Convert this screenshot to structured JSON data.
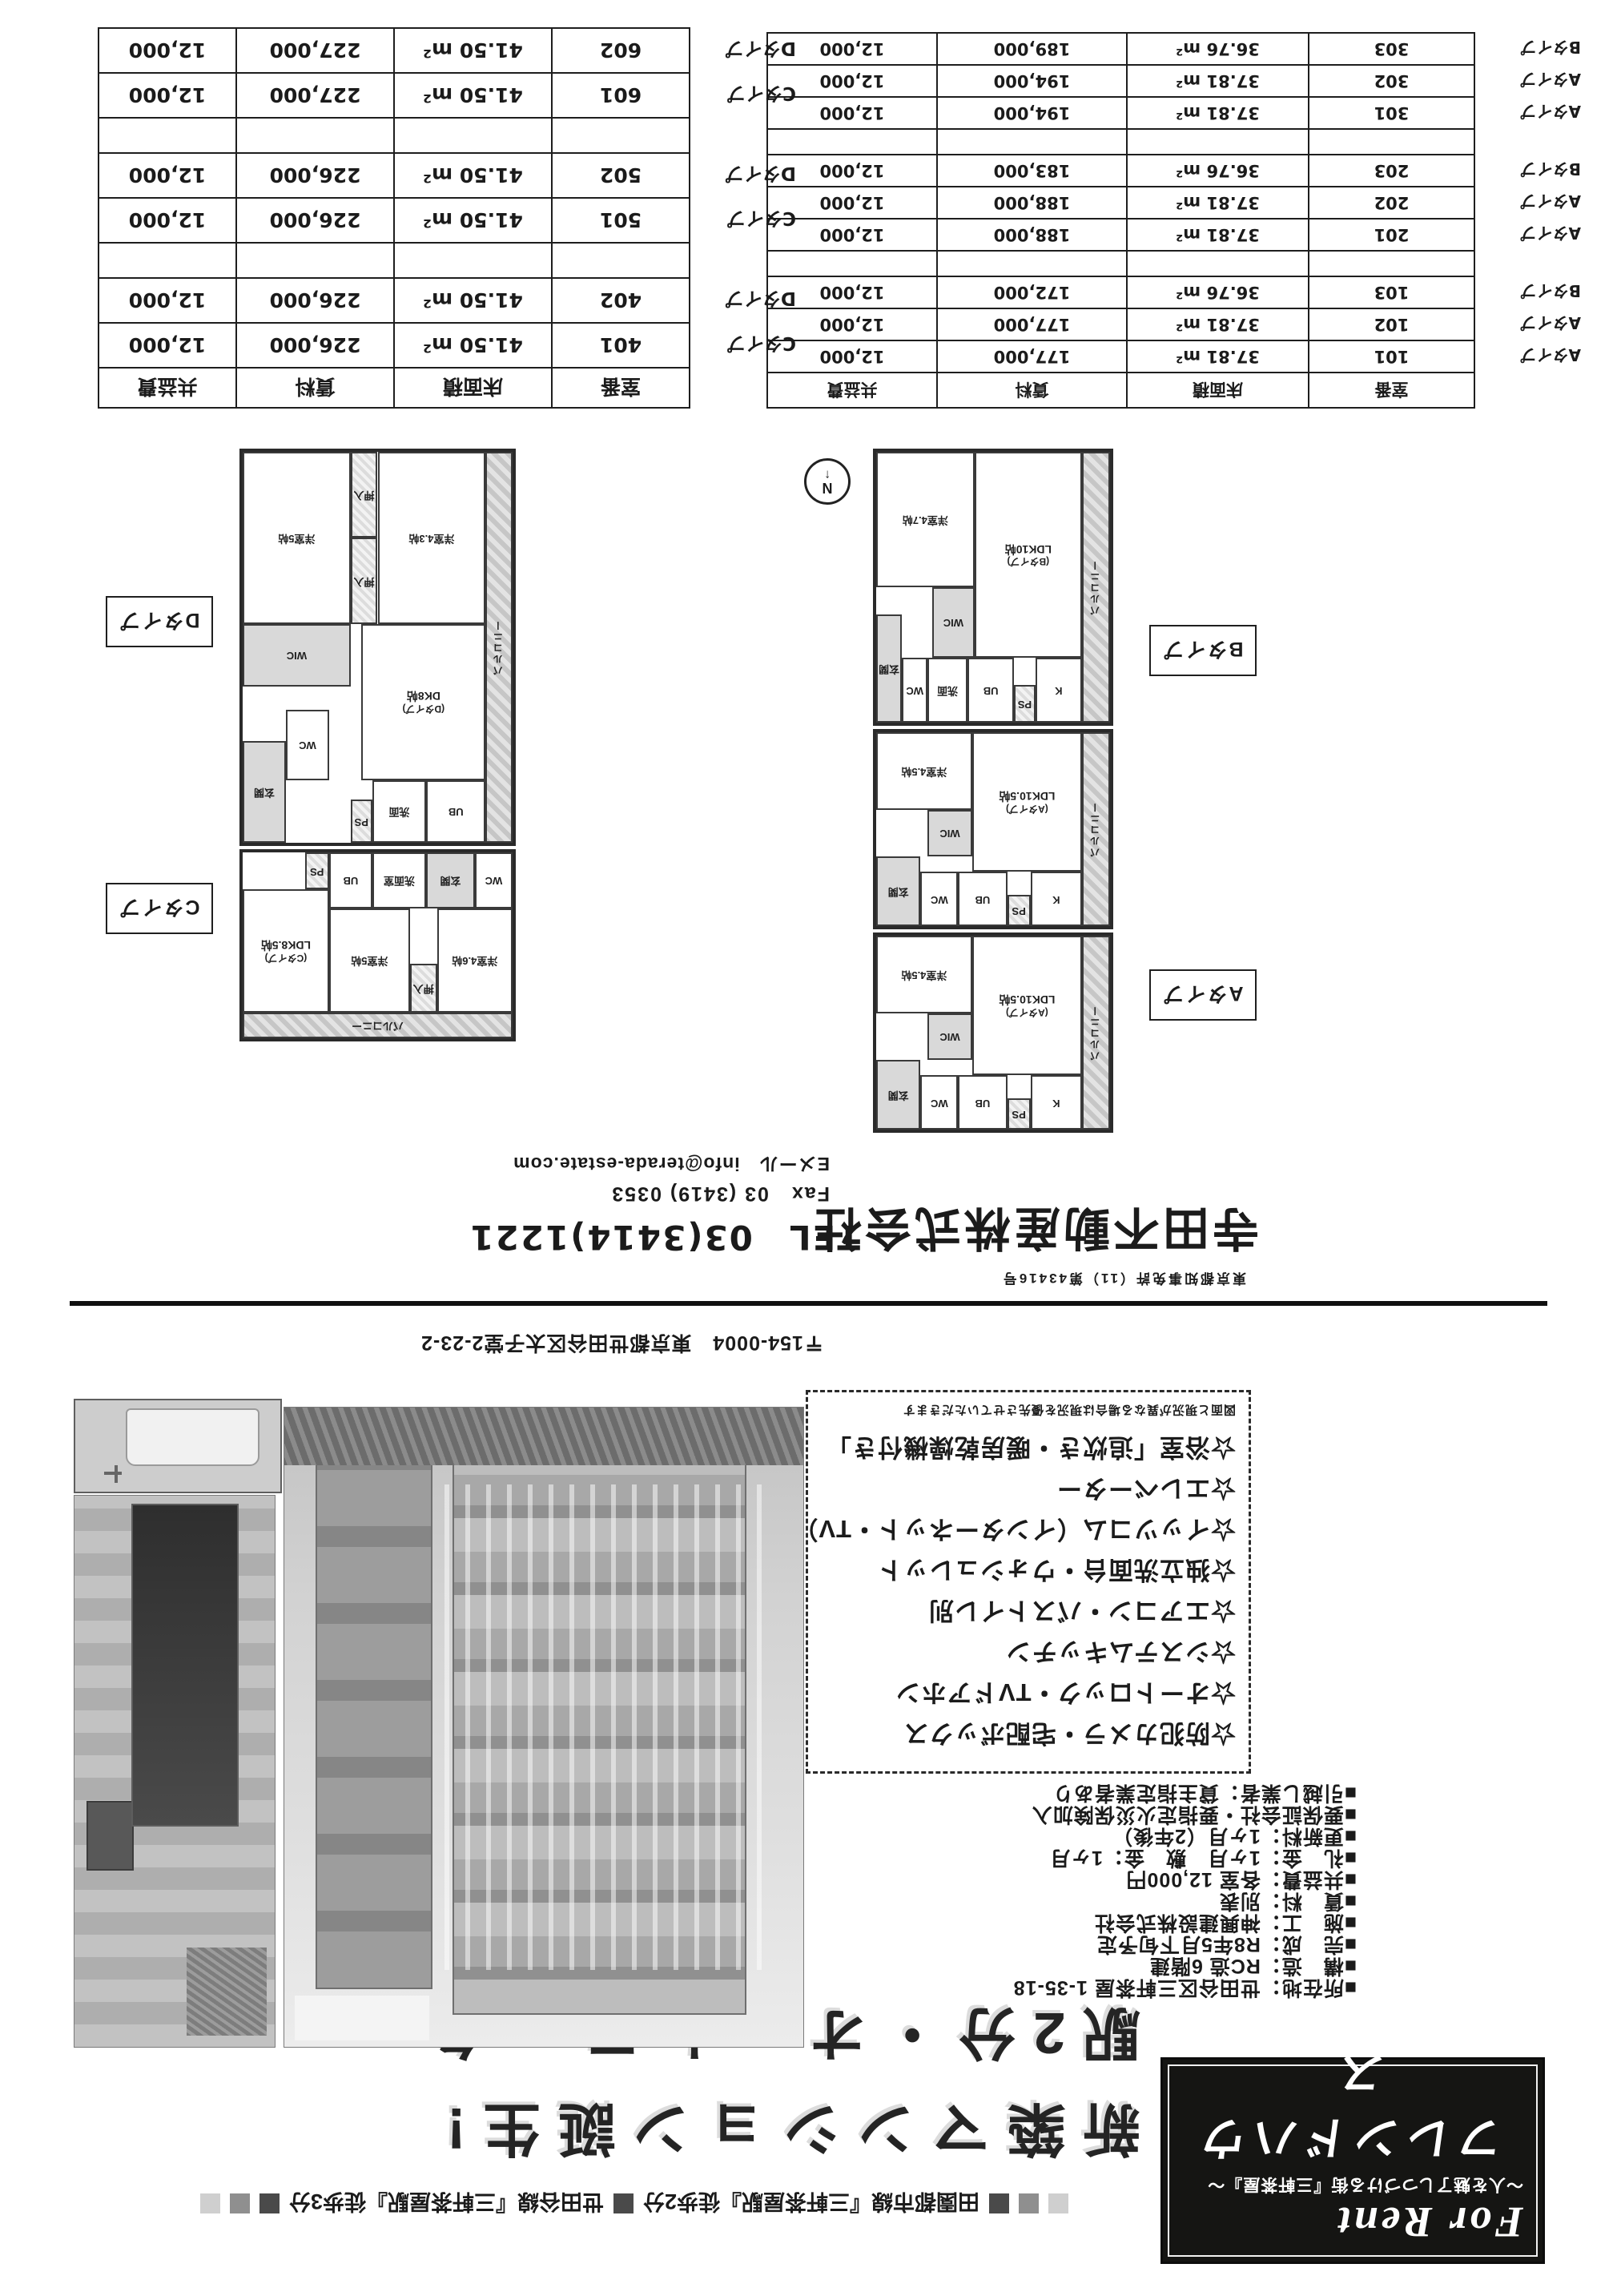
{
  "theme": {
    "ink": "#1b1b1b",
    "paper": "#ffffff",
    "gray_dark": "#4a4a4a",
    "gray_mid": "#8f8f8f",
    "gray_light": "#cfcfcf"
  },
  "title_banner": {
    "for_rent": "For Rent",
    "subtitle": "～人を魅了しつづける街『三軒茶屋』～",
    "property_name": "フレンドハウス"
  },
  "access_line": {
    "line1": "田園都市線『三軒茶屋駅』徒歩2分",
    "line2": "世田谷線『三軒茶屋駅』徒歩3分"
  },
  "headline": {
    "line1": "新築マンション誕生!",
    "line2": "駅2分・オートロック"
  },
  "property_details": {
    "items": [
      "■所在地：世田谷区三軒茶屋 1-35-18",
      "■構　造：RC造 6階建",
      "■完　成：R8年5月下旬予定",
      "■施　工：神興建設株式会社",
      "■賃　料：別表",
      "■共益費：各室 12,000円",
      "■礼　金：1ヶ月　敷　金：1ヶ月",
      "■更新料：1ヶ月（2年後）",
      "■要保証会社・要指定火災保険加入",
      "■引越し業者：貸主指定業者あり"
    ]
  },
  "features": {
    "items": [
      "☆防犯カメラ・宅配ボックス",
      "☆オートロック・TVドアホン",
      "☆システムキッチン",
      "☆エアコン・バストイレ別",
      "☆独立洗面台・ウォシュレット",
      "☆イッツコム（インターネット・TV）",
      "☆エレベーター",
      "☆浴室「追炊き・暖房乾燥機付き」"
    ],
    "note": "図面と現況が異なる場合は現況を優先させていただきます"
  },
  "company": {
    "license": "東京都知事免許（11）第43416号",
    "name": "寺田不動産株式会社",
    "address": "〒154-0004　東京都世田谷区太子堂2-23-2",
    "tel": "TEL　03(3414)1221",
    "fax": "Fax　03 (3419) 0353",
    "email": "Eメール　info@terada-estate.com"
  },
  "floor_plans": {
    "compass": "N",
    "compass_arrow": "↑",
    "label_a": "Aタイプ",
    "label_b": "Bタイプ",
    "label_c": "Cタイプ",
    "label_d": "Dタイプ",
    "unit_a": {
      "type": "(Aタイプ)",
      "ldk": "LDK10.5帖",
      "bed": "洋室4.5帖",
      "kitchen": "K",
      "wc": "WC",
      "ub": "UB",
      "wic": "WIC",
      "ps": "PS",
      "entry": "玄関",
      "balcony": "バルコニー"
    },
    "unit_b": {
      "type": "(Bタイプ)",
      "ldk": "LDK10帖",
      "bed": "洋室4.7帖",
      "kitchen": "K",
      "senmen": "洗面",
      "wc": "WC",
      "ub": "UB",
      "wic": "WIC",
      "ps": "PS",
      "entry": "玄関",
      "balcony": "バルコニー"
    },
    "unit_c": {
      "type": "(Cタイプ)",
      "ldk": "LDK8.5帖",
      "bed1": "洋室5帖",
      "bed2": "洋室4.6帖",
      "oshiire": "押入",
      "senmen": "洗面室",
      "wc": "WC",
      "ub": "UB",
      "ps": "PS",
      "entry": "玄関",
      "balcony": "バルコニー"
    },
    "unit_d": {
      "type": "(Dタイプ)",
      "dk": "DK8帖",
      "bed1": "洋室5帖",
      "bed2": "洋室4.3帖",
      "oshiire1": "押入",
      "oshiire2": "押入",
      "senmen": "洗面",
      "wic": "WIC",
      "wc": "WC",
      "ub": "UB",
      "ps": "PS",
      "entry": "玄関",
      "balcony": "バルコニー"
    }
  },
  "price_tables": {
    "headers": {
      "room": "室番",
      "area": "床面積",
      "rent": "賃料",
      "fee": "共益費"
    },
    "left_rows": [
      {
        "type": "Aタイプ",
        "room": "101",
        "area": "37.81 m²",
        "rent": "177,000",
        "fee": "12,000"
      },
      {
        "type": "Aタイプ",
        "room": "102",
        "area": "37.81 m²",
        "rent": "177,000",
        "fee": "12,000"
      },
      {
        "type": "Bタイプ",
        "room": "103",
        "area": "36.76 m²",
        "rent": "172,000",
        "fee": "12,000"
      },
      {
        "type": "",
        "room": "",
        "area": "",
        "rent": "",
        "fee": "",
        "blank": true
      },
      {
        "type": "Aタイプ",
        "room": "201",
        "area": "37.81 m²",
        "rent": "188,000",
        "fee": "12,000"
      },
      {
        "type": "Aタイプ",
        "room": "202",
        "area": "37.81 m²",
        "rent": "188,000",
        "fee": "12,000"
      },
      {
        "type": "Bタイプ",
        "room": "203",
        "area": "36.76 m²",
        "rent": "183,000",
        "fee": "12,000"
      },
      {
        "type": "",
        "room": "",
        "area": "",
        "rent": "",
        "fee": "",
        "blank": true
      },
      {
        "type": "Aタイプ",
        "room": "301",
        "area": "37.81 m²",
        "rent": "194,000",
        "fee": "12,000"
      },
      {
        "type": "Aタイプ",
        "room": "302",
        "area": "37.81 m²",
        "rent": "194,000",
        "fee": "12,000"
      },
      {
        "type": "Bタイプ",
        "room": "303",
        "area": "36.76 m²",
        "rent": "189,000",
        "fee": "12,000"
      }
    ],
    "right_rows": [
      {
        "type": "Cタイプ",
        "room": "401",
        "area": "41.50 m²",
        "rent": "226,000",
        "fee": "12,000"
      },
      {
        "type": "Dタイプ",
        "room": "402",
        "area": "41.50 m²",
        "rent": "226,000",
        "fee": "12,000"
      },
      {
        "type": "",
        "room": "",
        "area": "",
        "rent": "",
        "fee": "",
        "blank": true
      },
      {
        "type": "Cタイプ",
        "room": "501",
        "area": "41.50 m²",
        "rent": "226,000",
        "fee": "12,000"
      },
      {
        "type": "Dタイプ",
        "room": "502",
        "area": "41.50 m²",
        "rent": "226,000",
        "fee": "12,000"
      },
      {
        "type": "",
        "room": "",
        "area": "",
        "rent": "",
        "fee": "",
        "blank": true
      },
      {
        "type": "Cタイプ",
        "room": "601",
        "area": "41.50 m²",
        "rent": "227,000",
        "fee": "12,000"
      },
      {
        "type": "Dタイプ",
        "room": "602",
        "area": "41.50 m²",
        "rent": "227,000",
        "fee": "12,000"
      }
    ]
  }
}
